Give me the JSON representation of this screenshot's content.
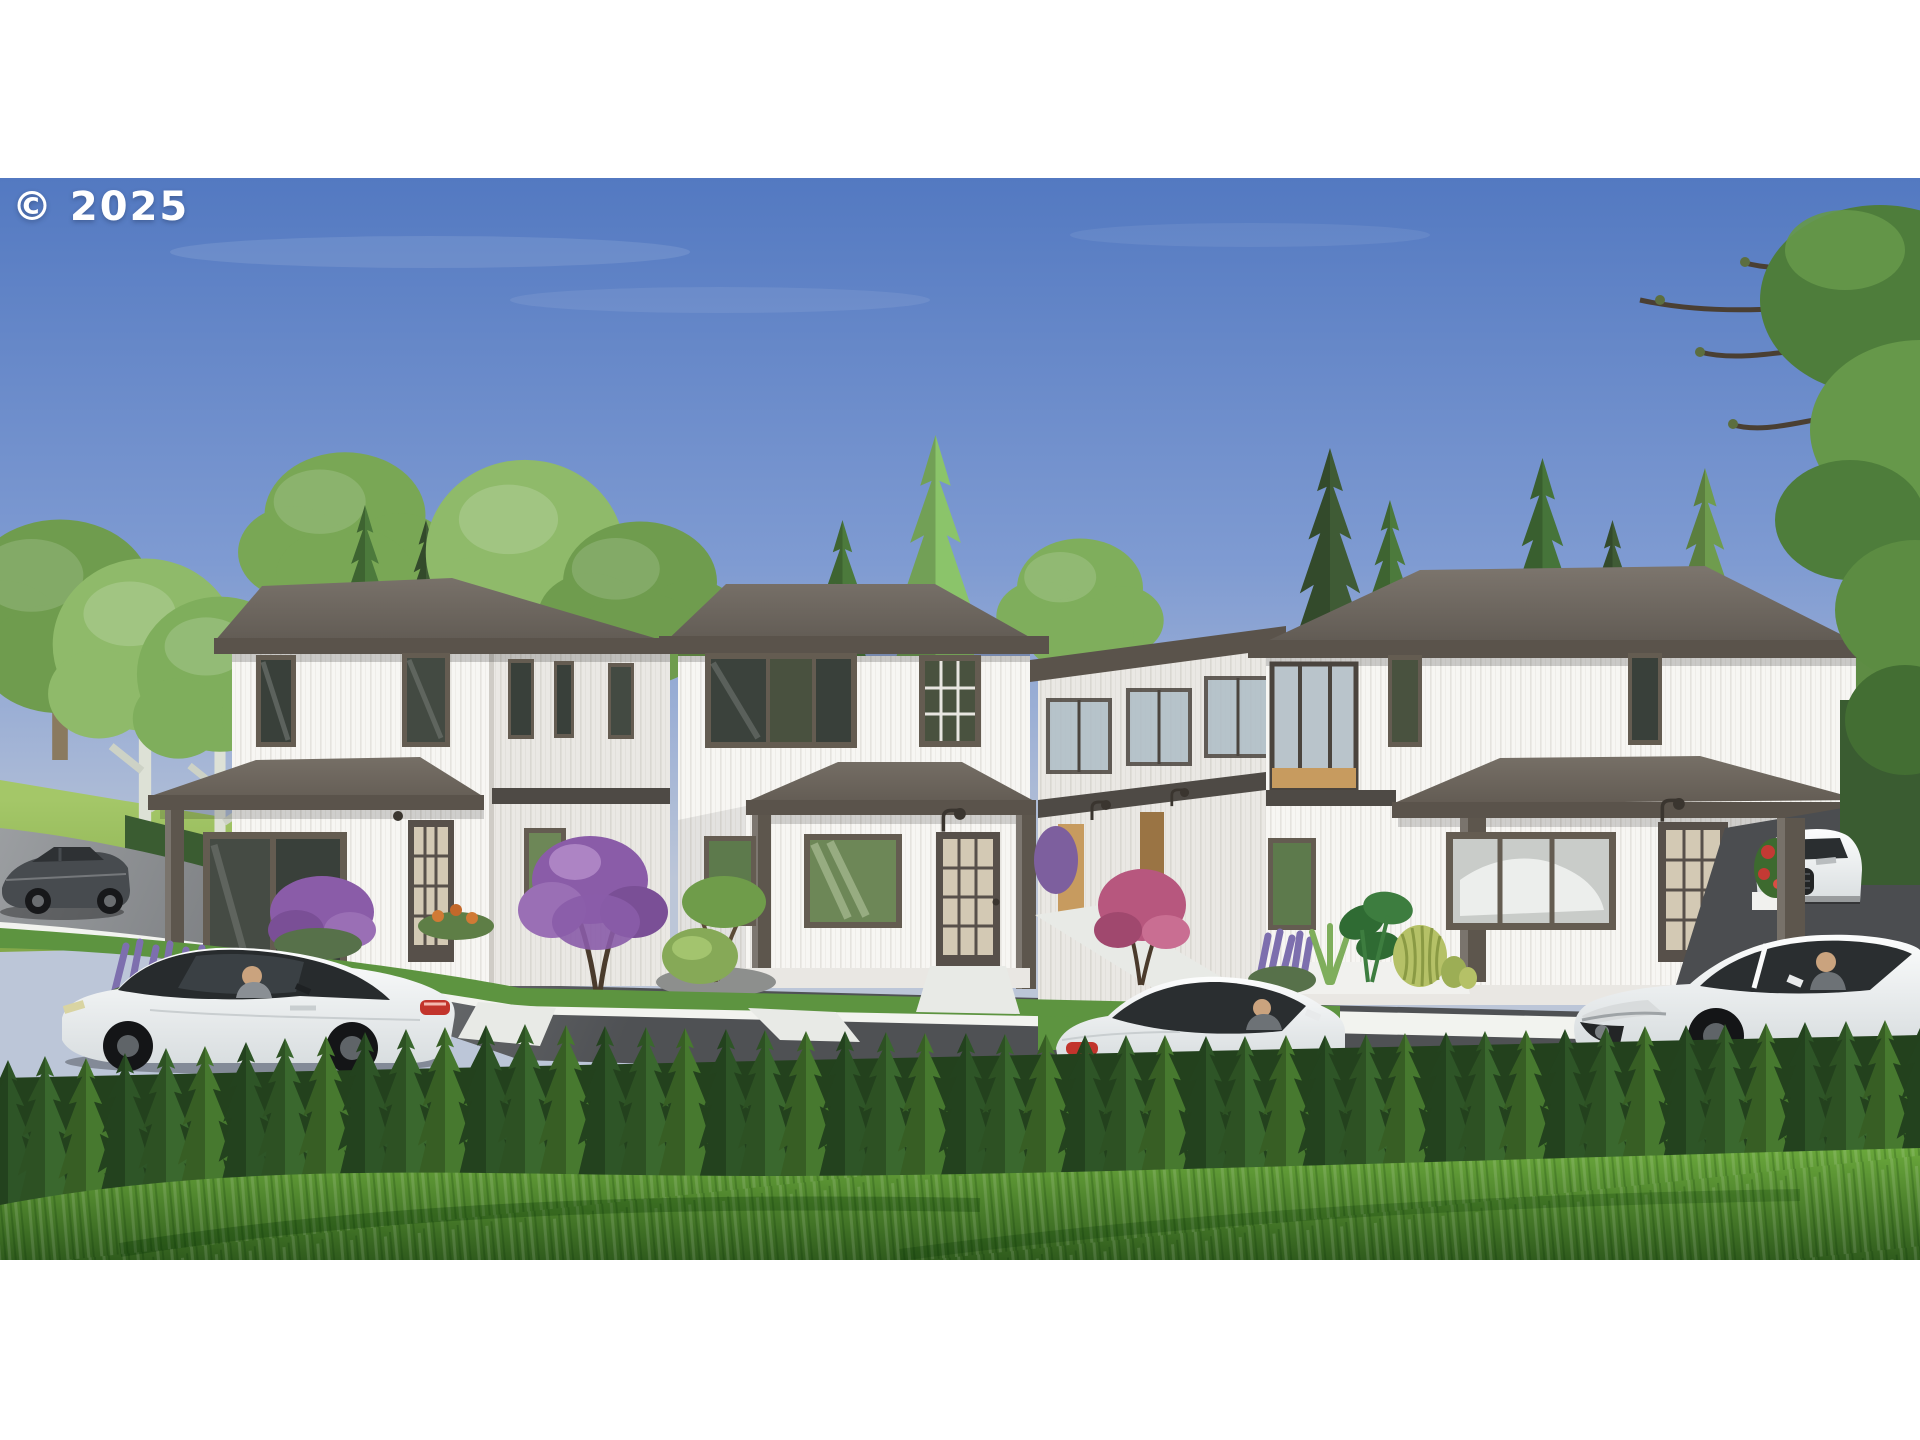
{
  "image": {
    "type": "real-estate-exterior-rendering",
    "subject": "Three modern two-story white single-family homes with dark hip roofs and covered front porches, plus a row of background townhomes with balconies",
    "setting": "suburban street scene, clear blue sky, hedge row and lawn in foreground, letterboxed photo with white bars top and bottom"
  },
  "watermark": {
    "text": "© 2025",
    "color": "#ffffff"
  },
  "palette": {
    "frame_white": "#ffffff",
    "sky_top": "#5379c1",
    "sky_mid": "#7f9bd2",
    "sky_horizon": "#bcc6d8",
    "roof_top": "#7b746c",
    "roof_dark": "#544e47",
    "fascia": "#5a534b",
    "porch_post": "#5d564d",
    "siding_white": "#f7f6f3",
    "siding_shade": "#eceae6",
    "trim_dark": "#645c51",
    "band_dark": "#4e4a45",
    "glass_dark": "#39403a",
    "glass_green": "#6d8757",
    "door_glass": "#d3c9b4",
    "balcony_glass": "#aebdc6",
    "wood": "#c79b5f",
    "meadow_light": "#a4c768",
    "meadow_dark": "#7da244",
    "tree_light": "#8fba6a",
    "tree_mid": "#6f9c4e",
    "tree_dark": "#4c7a3c",
    "conifer_dark": "#3f5b35",
    "hedge_dark": "#2e5527",
    "hedge_mid": "#3a682e",
    "hedge_light": "#47792f",
    "hedge_base": "#23411d",
    "grass_light": "#6fae3e",
    "grass_dark": "#2e5a1c",
    "street_far": "#9b9ea1",
    "street_near": "#4f5154",
    "curb": "#f2f3ef",
    "car_white": "#fafbfb",
    "car_glass": "#2a2e30",
    "car_dark_body": "#474b4f",
    "taillight": "#c2342c",
    "flower_purple": "#8a5ca8",
    "flower_lavender": "#7d6fae",
    "flower_pink": "#b7577e",
    "flower_red": "#c43a34",
    "flower_orange": "#d07a35",
    "cactus": "#b5c167",
    "trunk_birch": "#dde1d6"
  },
  "scene": {
    "houses": [
      {
        "label": "left-house",
        "stories": 2,
        "features": "white vertical siding, hip roof, covered entry porch, tall dark-framed windows, glazed front door"
      },
      {
        "label": "middle-house",
        "stories": 2,
        "features": "white vertical siding, hip roof, porch with two posts, large picture window, 15-lite glass door, gooseneck sconce"
      },
      {
        "label": "right-house",
        "stories": 2,
        "features": "wide hip roof, corner balcony with wood soffit, long porch, picture window, 15-lite glass door, cactus planter"
      }
    ],
    "background_units": {
      "label": "townhome-row",
      "features": "glass balconies, wood doors, gooseneck lamps, walkways"
    },
    "vehicles": [
      {
        "label": "dark-sedan",
        "color": "dark gray",
        "position": "far left, driving on street"
      },
      {
        "label": "white-coupe-left",
        "color": "white, black glass roof",
        "position": "parked in front of left house, driver inside"
      },
      {
        "label": "white-coupe-center",
        "color": "white",
        "position": "center street behind hedge, driver inside"
      },
      {
        "label": "white-sedan-right",
        "color": "white",
        "position": "right street behind hedge, driver inside"
      },
      {
        "label": "white-suv",
        "color": "white",
        "position": "far right driveway behind porch post"
      }
    ],
    "vegetation": [
      "foreground lawn",
      "cypress hedge row",
      "birch and leafy trees left",
      "tall conifers behind houses",
      "overhanging leafy tree top right",
      "purple crape myrtle",
      "lavender clusters",
      "pink shrub",
      "red flower planter",
      "barrel cactus and monstera planter",
      "round boxwood with ornamental tree"
    ],
    "street": [
      "curved asphalt street",
      "white concrete curb and walkways",
      "driveway at right"
    ]
  }
}
